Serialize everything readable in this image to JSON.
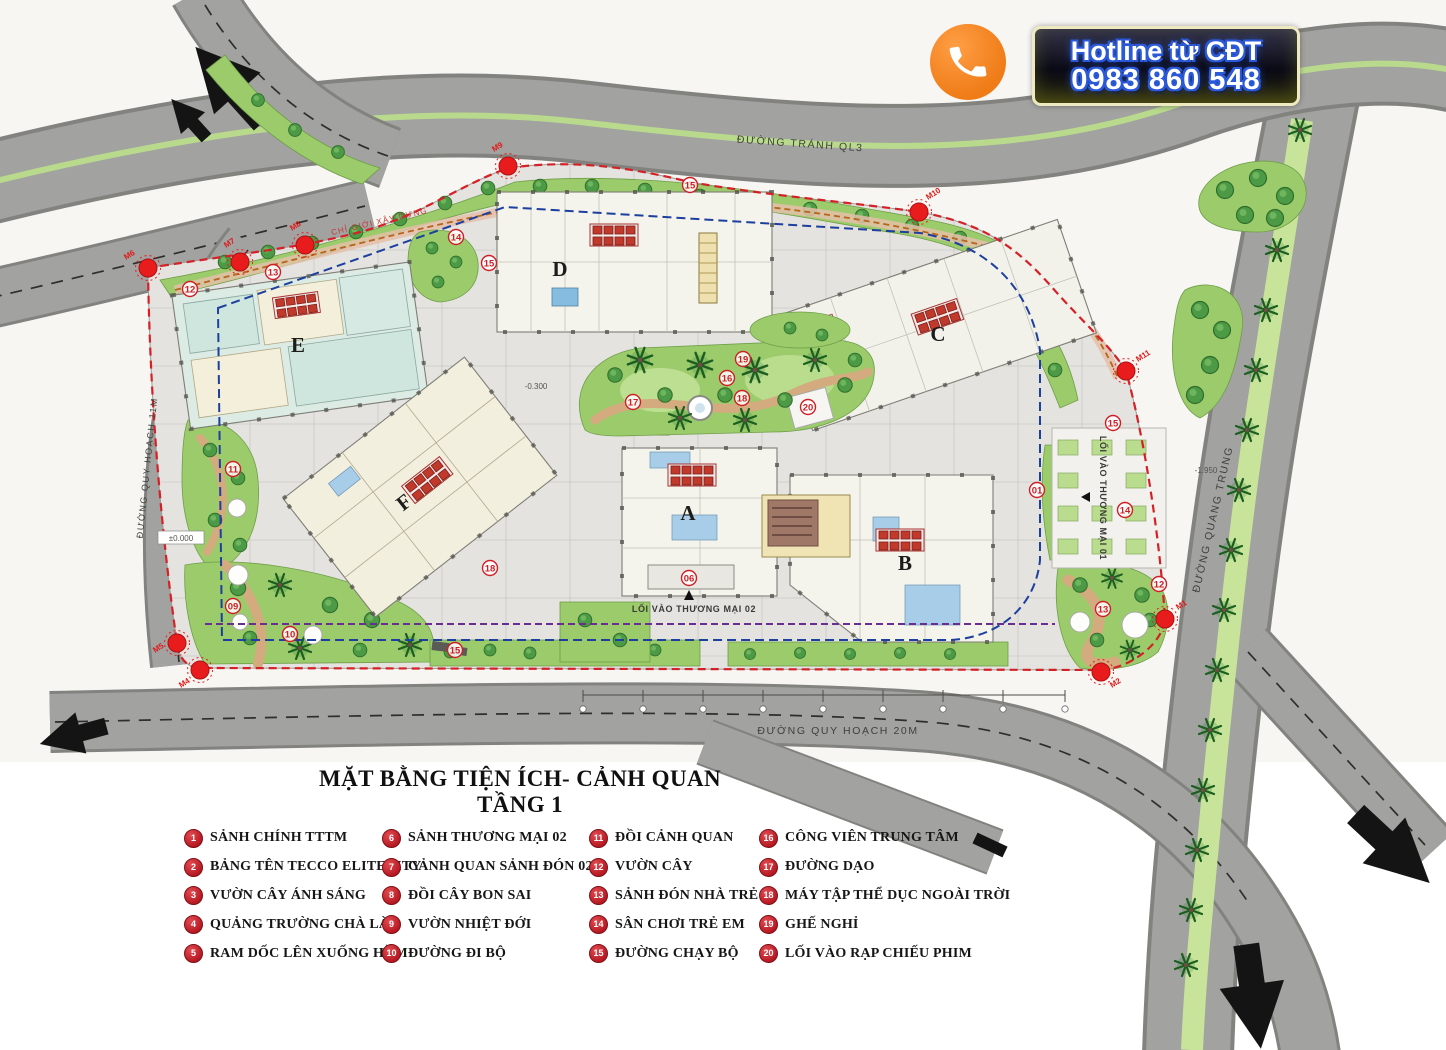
{
  "hotline": {
    "title": "Hotline từ CĐT",
    "phone": "0983 860 548"
  },
  "title": "MẶT BẰNG TIỆN ÍCH- CẢNH QUAN TẦNG 1",
  "legend": {
    "items": [
      {
        "num": "1",
        "label": "SẢNH CHÍNH TTTM"
      },
      {
        "num": "2",
        "label": "BẢNG TÊN TECCO ELITECITY"
      },
      {
        "num": "3",
        "label": "VƯỜN CÂY ÁNH SÁNG"
      },
      {
        "num": "4",
        "label": "QUẢNG TRƯỜNG CHÀ LÀ"
      },
      {
        "num": "5",
        "label": "RAM DỐC LÊN XUỐNG HẦM"
      },
      {
        "num": "6",
        "label": "SẢNH THƯƠNG MẠI 02"
      },
      {
        "num": "7",
        "label": "CẢNH QUAN SẢNH ĐÓN 02"
      },
      {
        "num": "8",
        "label": "ĐỒI CÂY BON SAI"
      },
      {
        "num": "9",
        "label": "VƯỜN NHIỆT ĐỚI"
      },
      {
        "num": "10",
        "label": "ĐƯỜNG ĐI BỘ"
      },
      {
        "num": "11",
        "label": "ĐỒI CẢNH QUAN"
      },
      {
        "num": "12",
        "label": "VƯỜN CÂY"
      },
      {
        "num": "13",
        "label": "SẢNH ĐÓN NHÀ TRẺ"
      },
      {
        "num": "14",
        "label": "SÂN CHƠI TRẺ EM"
      },
      {
        "num": "15",
        "label": "ĐƯỜNG CHẠY BỘ"
      },
      {
        "num": "16",
        "label": "CÔNG VIÊN TRUNG TÂM"
      },
      {
        "num": "17",
        "label": "ĐƯỜNG DẠO"
      },
      {
        "num": "18",
        "label": "MÁY TẬP THỂ DỤC NGOÀI TRỜI"
      },
      {
        "num": "19",
        "label": "GHẾ NGHỈ"
      },
      {
        "num": "20",
        "label": "LỐI VÀO RẠP CHIẾU PHIM"
      }
    ]
  },
  "map": {
    "buildings": [
      "A",
      "B",
      "C",
      "D",
      "E",
      "F"
    ],
    "roads": {
      "top": "ĐƯỜNG TRÁNH QL3",
      "right": "ĐƯỜNG QUANG TRUNG",
      "bottom": "ĐƯỜNG QUY HOẠCH 20M",
      "left": "ĐƯỜNG QUY HOẠCH 11M"
    },
    "entrances": {
      "e01": "LỐI VÀO THƯƠNG MẠI 01",
      "e02": "LỐI VÀO THƯƠNG MẠI 02"
    },
    "boundary_label": "CHỈ GIỚI XÂY DỰNG",
    "levels": {
      "zero": "±0.000",
      "l03": "-0.300",
      "l195": "-1.950"
    },
    "m_markers": [
      "M1",
      "M2",
      "M4",
      "M5",
      "M6",
      "M7",
      "M8",
      "M9",
      "M10",
      "M11"
    ],
    "num_markers": [
      "12",
      "13",
      "14",
      "15",
      "15",
      "17",
      "19",
      "16",
      "18",
      "20",
      "18",
      "09",
      "10",
      "11",
      "06",
      "01",
      "14",
      "15",
      "12",
      "13",
      "15"
    ]
  },
  "colors": {
    "marker_red": "#c4242c",
    "lawn_green": "#9ccb6c",
    "road_gray": "#a2a2a0",
    "banner_orange": "#ef7c17",
    "dash_red": "#d42127",
    "dash_blue": "#1d3f9e",
    "dash_purple": "#6a2d91"
  }
}
